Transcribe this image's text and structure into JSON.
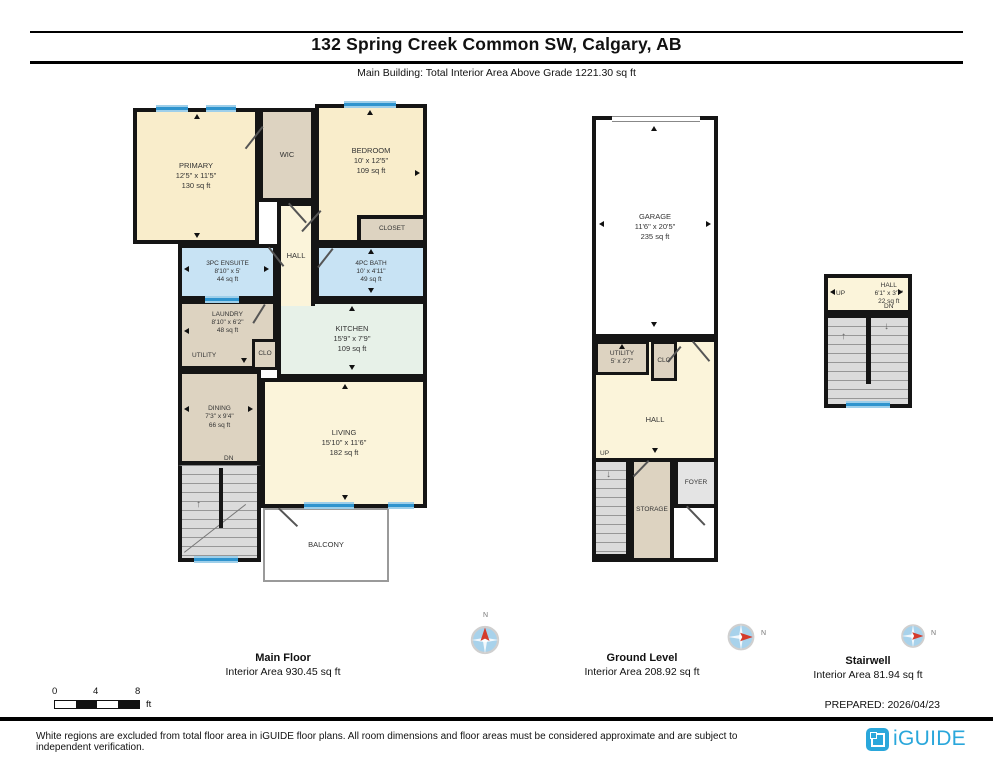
{
  "header": {
    "title": "132 Spring Creek Common SW, Calgary, AB",
    "subtitle": "Main Building: Total Interior Area Above Grade 1221.30 sq ft"
  },
  "plans": {
    "main_floor": {
      "label": "Main Floor",
      "area_label": "Interior Area 930.45 sq ft",
      "rooms": {
        "primary": {
          "name": "PRIMARY",
          "dims": "12'5\" x 11'5\"",
          "area": "130 sq ft"
        },
        "wic": {
          "name": "WIC"
        },
        "bedroom": {
          "name": "BEDROOM",
          "dims": "10' x 12'5\"",
          "area": "109 sq ft"
        },
        "closet": {
          "name": "CLOSET"
        },
        "hall": {
          "name": "HALL"
        },
        "ensuite": {
          "name": "3PC ENSUITE",
          "dims": "8'10\" x 5'",
          "area": "44 sq ft"
        },
        "bath": {
          "name": "4PC BATH",
          "dims": "10' x 4'11\"",
          "area": "49 sq ft"
        },
        "laundry": {
          "name": "LAUNDRY",
          "dims": "8'10\" x 6'2\"",
          "area": "48 sq ft"
        },
        "utility": {
          "name": "UTILITY"
        },
        "clo": {
          "name": "CLO"
        },
        "kitchen": {
          "name": "KITCHEN",
          "dims": "15'9\" x 7'9\"",
          "area": "109 sq ft"
        },
        "dining": {
          "name": "DINING",
          "dims": "7'3\" x 9'4\"",
          "area": "66 sq ft"
        },
        "living": {
          "name": "LIVING",
          "dims": "15'10\" x 11'6\"",
          "area": "182 sq ft"
        },
        "balcony": {
          "name": "BALCONY"
        },
        "stairs": {
          "dn": "DN"
        }
      }
    },
    "ground_level": {
      "label": "Ground Level",
      "area_label": "Interior Area 208.92 sq ft",
      "rooms": {
        "garage": {
          "name": "GARAGE",
          "dims": "11'6\" x 20'5\"",
          "area": "235 sq ft"
        },
        "utility": {
          "name": "UTILITY",
          "dims": "5' x 2'7\""
        },
        "clo": {
          "name": "CLO"
        },
        "hall": {
          "name": "HALL"
        },
        "storage": {
          "name": "STORAGE"
        },
        "foyer": {
          "name": "FOYER"
        },
        "stairs": {
          "up": "UP"
        }
      }
    },
    "stairwell": {
      "label": "Stairwell",
      "area_label": "Interior Area 81.94 sq ft",
      "rooms": {
        "hall": {
          "name": "HALL",
          "dims": "6'1\" x 3'7\"",
          "area": "22 sq ft"
        },
        "stairs": {
          "up": "UP",
          "dn": "DN"
        }
      }
    }
  },
  "compass": {
    "north": "N"
  },
  "icons": {
    "up_arrow": "↑",
    "down_arrow": "↓"
  },
  "footer": {
    "scale": {
      "zero": "0",
      "four": "4",
      "eight": "8",
      "unit": "ft"
    },
    "prepared": "PREPARED: 2026/04/23",
    "disclaimer": "White regions are excluded from total floor area in iGUIDE floor plans. All room dimensions and floor areas must be considered approximate and are subject to independent verification.",
    "brand": "iGUIDE"
  },
  "colors": {
    "accent_blue": "#2AA7DB",
    "window_blue": "#2F94CE",
    "compass_red": "#D43B2B"
  }
}
